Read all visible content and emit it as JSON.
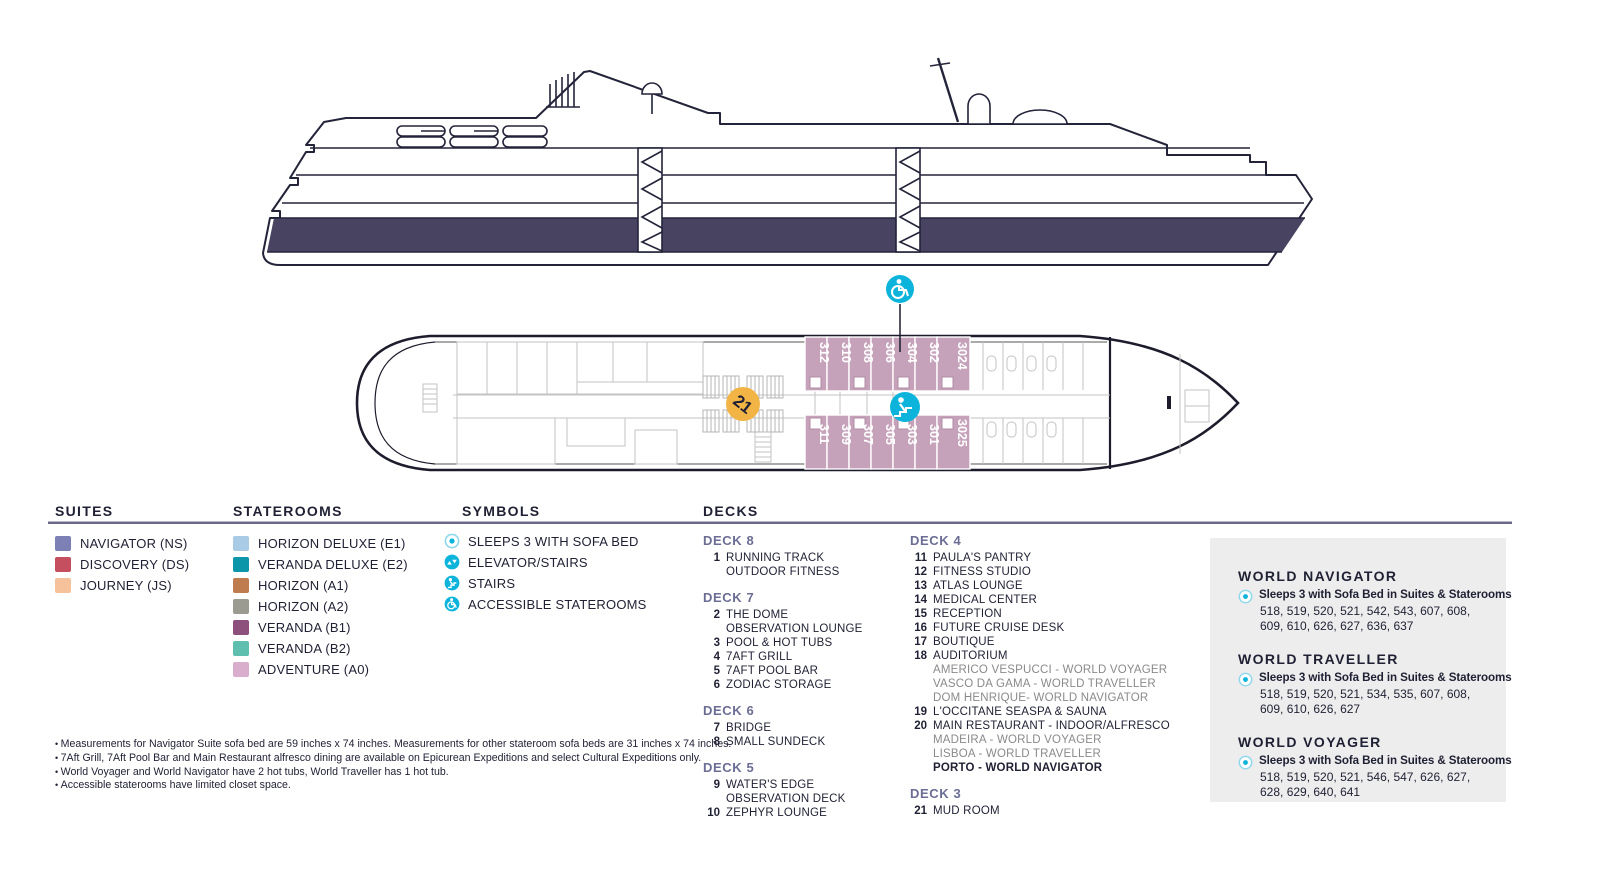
{
  "colors": {
    "accent_cyan": "#0cb4dc",
    "marker_orange": "#f2b445",
    "cabin_pink": "#c5a2ba",
    "hull_navy": "#474361",
    "rule_gray": "#6a6888",
    "deck_heading": "#6b6d95",
    "subtext_gray": "#8a8a8a",
    "panel_bg": "#ededed"
  },
  "suites": {
    "title": "SUITES",
    "items": [
      {
        "label": "NAVIGATOR (NS)",
        "color": "#7c80b5"
      },
      {
        "label": "DISCOVERY (DS)",
        "color": "#c54f5f"
      },
      {
        "label": "JOURNEY (JS)",
        "color": "#f5c29c"
      }
    ]
  },
  "staterooms": {
    "title": "STATEROOMS",
    "items": [
      {
        "label": "HORIZON DELUXE (E1)",
        "color": "#a9cbe5"
      },
      {
        "label": "VERANDA DELUXE (E2)",
        "color": "#0c96aa"
      },
      {
        "label": "HORIZON (A1)",
        "color": "#bf7c4f"
      },
      {
        "label": "HORIZON (A2)",
        "color": "#9b9b91"
      },
      {
        "label": "VERANDA (B1)",
        "color": "#8d4f7c"
      },
      {
        "label": "VERANDA (B2)",
        "color": "#5fbfae"
      },
      {
        "label": "ADVENTURE (A0)",
        "color": "#d9aecd"
      }
    ]
  },
  "symbols": {
    "title": "SYMBOLS",
    "items": [
      {
        "label": "SLEEPS 3 WITH SOFA BED",
        "icon": "sleeps3-icon"
      },
      {
        "label": "ELEVATOR/STAIRS",
        "icon": "elevator-icon"
      },
      {
        "label": "STAIRS",
        "icon": "stairs-icon"
      },
      {
        "label": "ACCESSIBLE STATEROOMS",
        "icon": "accessible-icon"
      }
    ]
  },
  "decks": {
    "title": "DECKS",
    "groups": [
      {
        "name": "DECK 8",
        "entries": [
          {
            "num": "1",
            "lines": [
              "RUNNING TRACK",
              "OUTDOOR FITNESS"
            ]
          }
        ]
      },
      {
        "name": "DECK 7",
        "entries": [
          {
            "num": "2",
            "lines": [
              "THE DOME",
              "OBSERVATION LOUNGE"
            ]
          },
          {
            "num": "3",
            "lines": [
              "POOL & HOT TUBS"
            ]
          },
          {
            "num": "4",
            "lines": [
              "7AFT GRILL"
            ]
          },
          {
            "num": "5",
            "lines": [
              "7AFT POOL BAR"
            ]
          },
          {
            "num": "6",
            "lines": [
              "ZODIAC STORAGE"
            ]
          }
        ]
      },
      {
        "name": "DECK 6",
        "entries": [
          {
            "num": "7",
            "lines": [
              "BRIDGE"
            ]
          },
          {
            "num": "8",
            "lines": [
              "SMALL SUNDECK"
            ]
          }
        ]
      },
      {
        "name": "DECK 5",
        "entries": [
          {
            "num": "9",
            "lines": [
              "WATER'S EDGE",
              "OBSERVATION DECK"
            ]
          },
          {
            "num": "10",
            "lines": [
              "ZEPHYR LOUNGE"
            ]
          }
        ]
      },
      {
        "name": "DECK 4",
        "entries": [
          {
            "num": "11",
            "lines": [
              "PAULA'S PANTRY"
            ]
          },
          {
            "num": "12",
            "lines": [
              "FITNESS STUDIO"
            ]
          },
          {
            "num": "13",
            "lines": [
              "ATLAS LOUNGE"
            ]
          },
          {
            "num": "14",
            "lines": [
              "MEDICAL CENTER"
            ]
          },
          {
            "num": "15",
            "lines": [
              "RECEPTION"
            ]
          },
          {
            "num": "16",
            "lines": [
              "FUTURE CRUISE DESK"
            ]
          },
          {
            "num": "17",
            "lines": [
              "BOUTIQUE"
            ]
          },
          {
            "num": "18",
            "lines": [
              "AUDITORIUM"
            ],
            "sublines": [
              "AMERICO VESPUCCI - WORLD VOYAGER",
              "VASCO DA GAMA - WORLD TRAVELLER",
              "DOM HENRIQUE- WORLD NAVIGATOR"
            ]
          },
          {
            "num": "19",
            "lines": [
              "L'OCCITANE SEASPA & SAUNA"
            ]
          },
          {
            "num": "20",
            "lines": [
              "MAIN RESTAURANT - INDOOR/ALFRESCO"
            ],
            "sublines": [
              "MADEIRA - WORLD VOYAGER",
              "LISBOA - WORLD TRAVELLER"
            ],
            "subline_bold": "PORTO - WORLD NAVIGATOR"
          }
        ]
      },
      {
        "name": "DECK 3",
        "entries": [
          {
            "num": "21",
            "lines": [
              "MUD ROOM"
            ]
          }
        ]
      }
    ]
  },
  "ships": [
    {
      "name": "WORLD NAVIGATOR",
      "bold": "Sleeps 3 with Sofa Bed in Suites & Staterooms",
      "rooms": "518, 519, 520, 521, 542, 543, 607, 608, 609, 610, 626, 627, 636, 637"
    },
    {
      "name": "WORLD TRAVELLER",
      "bold": "Sleeps 3 with Sofa Bed in Suites & Staterooms",
      "rooms": "518, 519, 520, 521, 534, 535, 607, 608, 609, 610, 626, 627"
    },
    {
      "name": "WORLD VOYAGER",
      "bold": "Sleeps 3 with Sofa Bed in Suites & Staterooms",
      "rooms": "518, 519, 520, 521, 546, 547, 626, 627, 628, 629, 640, 641"
    }
  ],
  "footnotes": [
    "Measurements for Navigator Suite sofa bed are 59 inches x 74 inches. Measurements for other stateroom sofa beds are 31 inches x 74 inches.",
    "7Aft Grill, 7Aft Pool Bar and Main Restaurant alfresco dining are available on Epicurean Expeditions and select Cultural Expeditions only.",
    "World Voyager and World Navigator have 2 hot tubs, World Traveller has 1 hot tub.",
    "Accessible staterooms have limited closet space."
  ],
  "deck_plan": {
    "marker_label": "21",
    "cabins_top": [
      "312",
      "310",
      "308",
      "306",
      "304",
      "302",
      "3024"
    ],
    "cabins_bottom": [
      "311",
      "309",
      "307",
      "305",
      "303",
      "301",
      "3025"
    ]
  }
}
